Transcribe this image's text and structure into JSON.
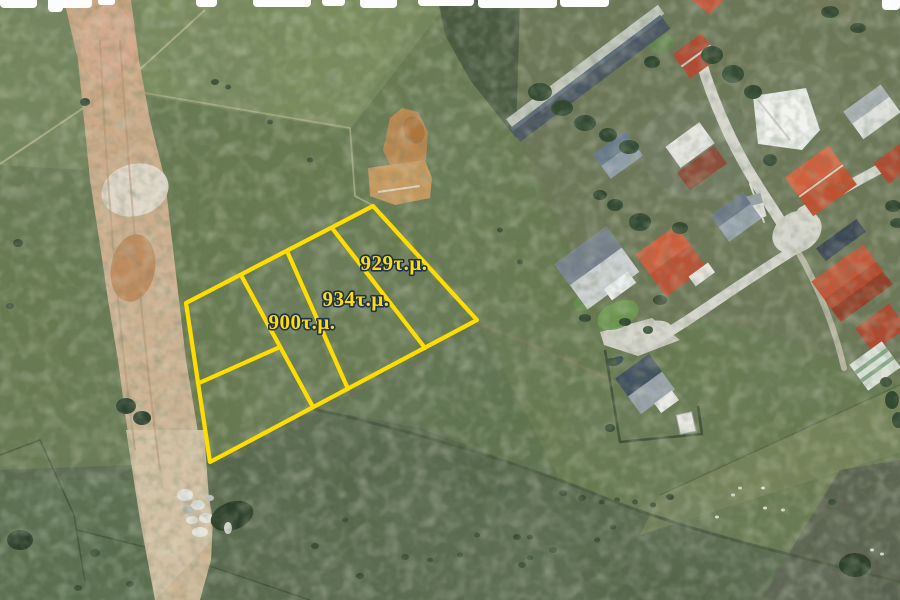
{
  "map": {
    "kind": "satellite-aerial-photo",
    "overlay": "land-parcel-boundaries"
  },
  "parcels": {
    "outline_color": "#ffdd00",
    "label_fill": "#ffdf00",
    "label_outline_color": "#1e2f55",
    "list": [
      {
        "id": "parcel-929",
        "area_label": "929τ.μ."
      },
      {
        "id": "parcel-934",
        "area_label": "934τ.μ."
      },
      {
        "id": "parcel-900",
        "area_label": "900τ.μ."
      }
    ]
  },
  "watermark": {
    "description": "cut-off white letter fragments along top edge",
    "color": "#ffffff"
  }
}
